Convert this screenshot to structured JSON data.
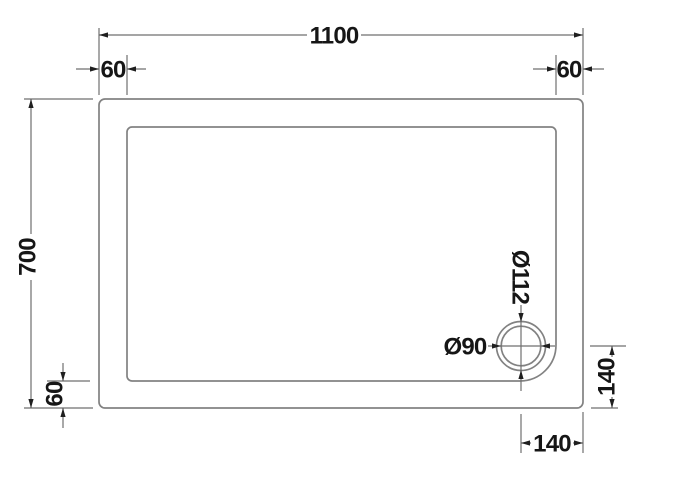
{
  "drawing": {
    "kind": "shower-tray-plan-technical-drawing",
    "colors": {
      "background": "#ffffff",
      "tray_line": "#828282",
      "dimension_line": "#6f6f6f",
      "text": "#161616",
      "arrow": "#1f1f1f"
    },
    "dims": {
      "overall_width": "1100",
      "overall_depth": "700",
      "edge_top_left": "60",
      "edge_top_right": "60",
      "edge_bottom_left": "60",
      "waste_outer_diameter": "Ø112",
      "waste_inner_diameter": "Ø90",
      "waste_center_to_bottom": "140",
      "waste_center_to_right": "140"
    }
  }
}
